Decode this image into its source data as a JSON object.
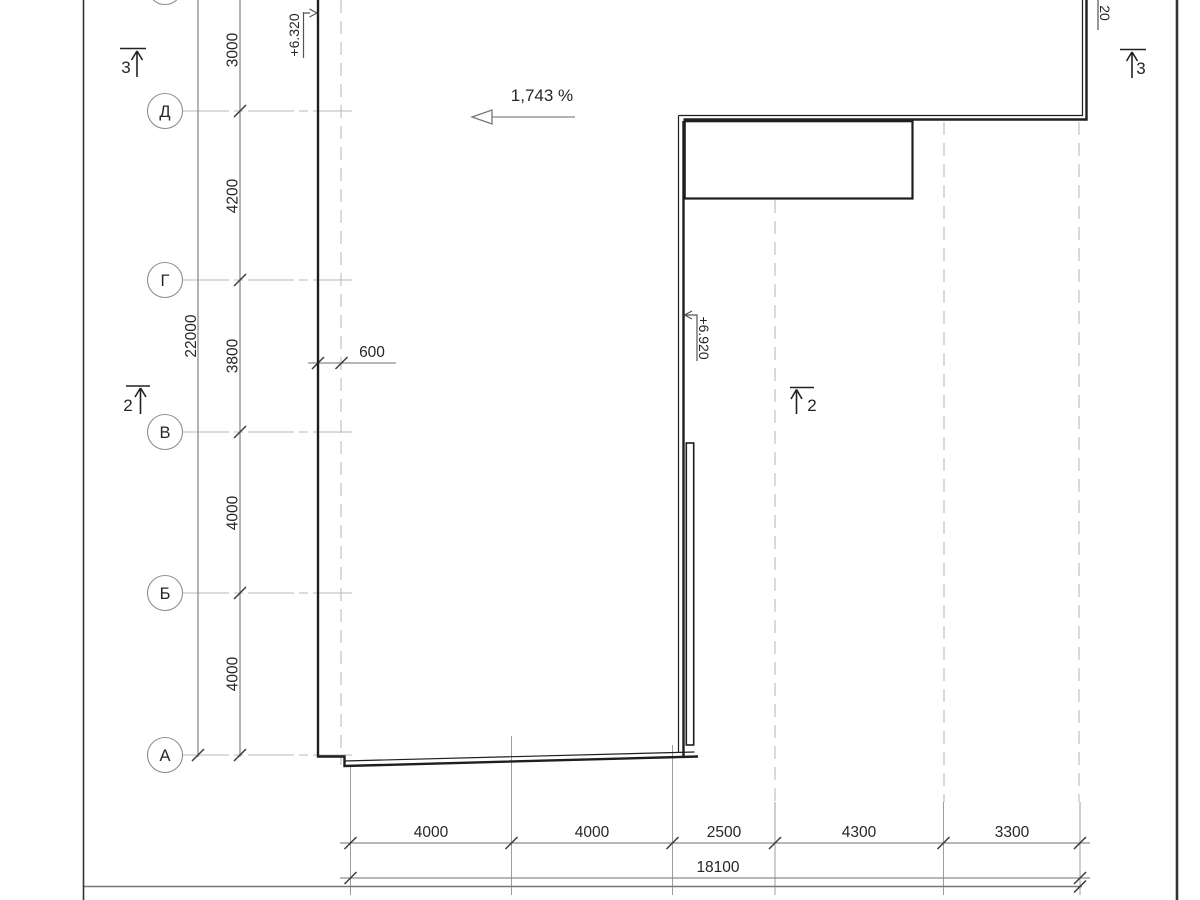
{
  "title": "roof-plan-drawing",
  "colors": {
    "line_dark": "#1e1e1e",
    "line_dim": "#8c8c8c",
    "line_tick": "#3c3c3c",
    "line_grid_dashed": "#c7c7c7",
    "line_axis": "#b8b8b8",
    "text": "#262626",
    "background": "#ffffff"
  },
  "axes": {
    "row_labels": [
      "Д",
      "Г",
      "В",
      "Б",
      "А"
    ]
  },
  "dims": {
    "left_intervals": [
      "3000",
      "4200",
      "3800",
      "4000",
      "4000"
    ],
    "left_total": "22000",
    "offset": "600",
    "bottom_intervals": [
      "4000",
      "4000",
      "2500",
      "4300",
      "3300"
    ],
    "bottom_total": "18100"
  },
  "annotations": {
    "slope": "1,743 %",
    "elev_left": "+6.320",
    "elev_mid": "+6.920",
    "elev_corner_partial": "20"
  },
  "sections": {
    "top_left": "3",
    "top_right": "3",
    "mid_left": "2",
    "mid_center": "2"
  }
}
